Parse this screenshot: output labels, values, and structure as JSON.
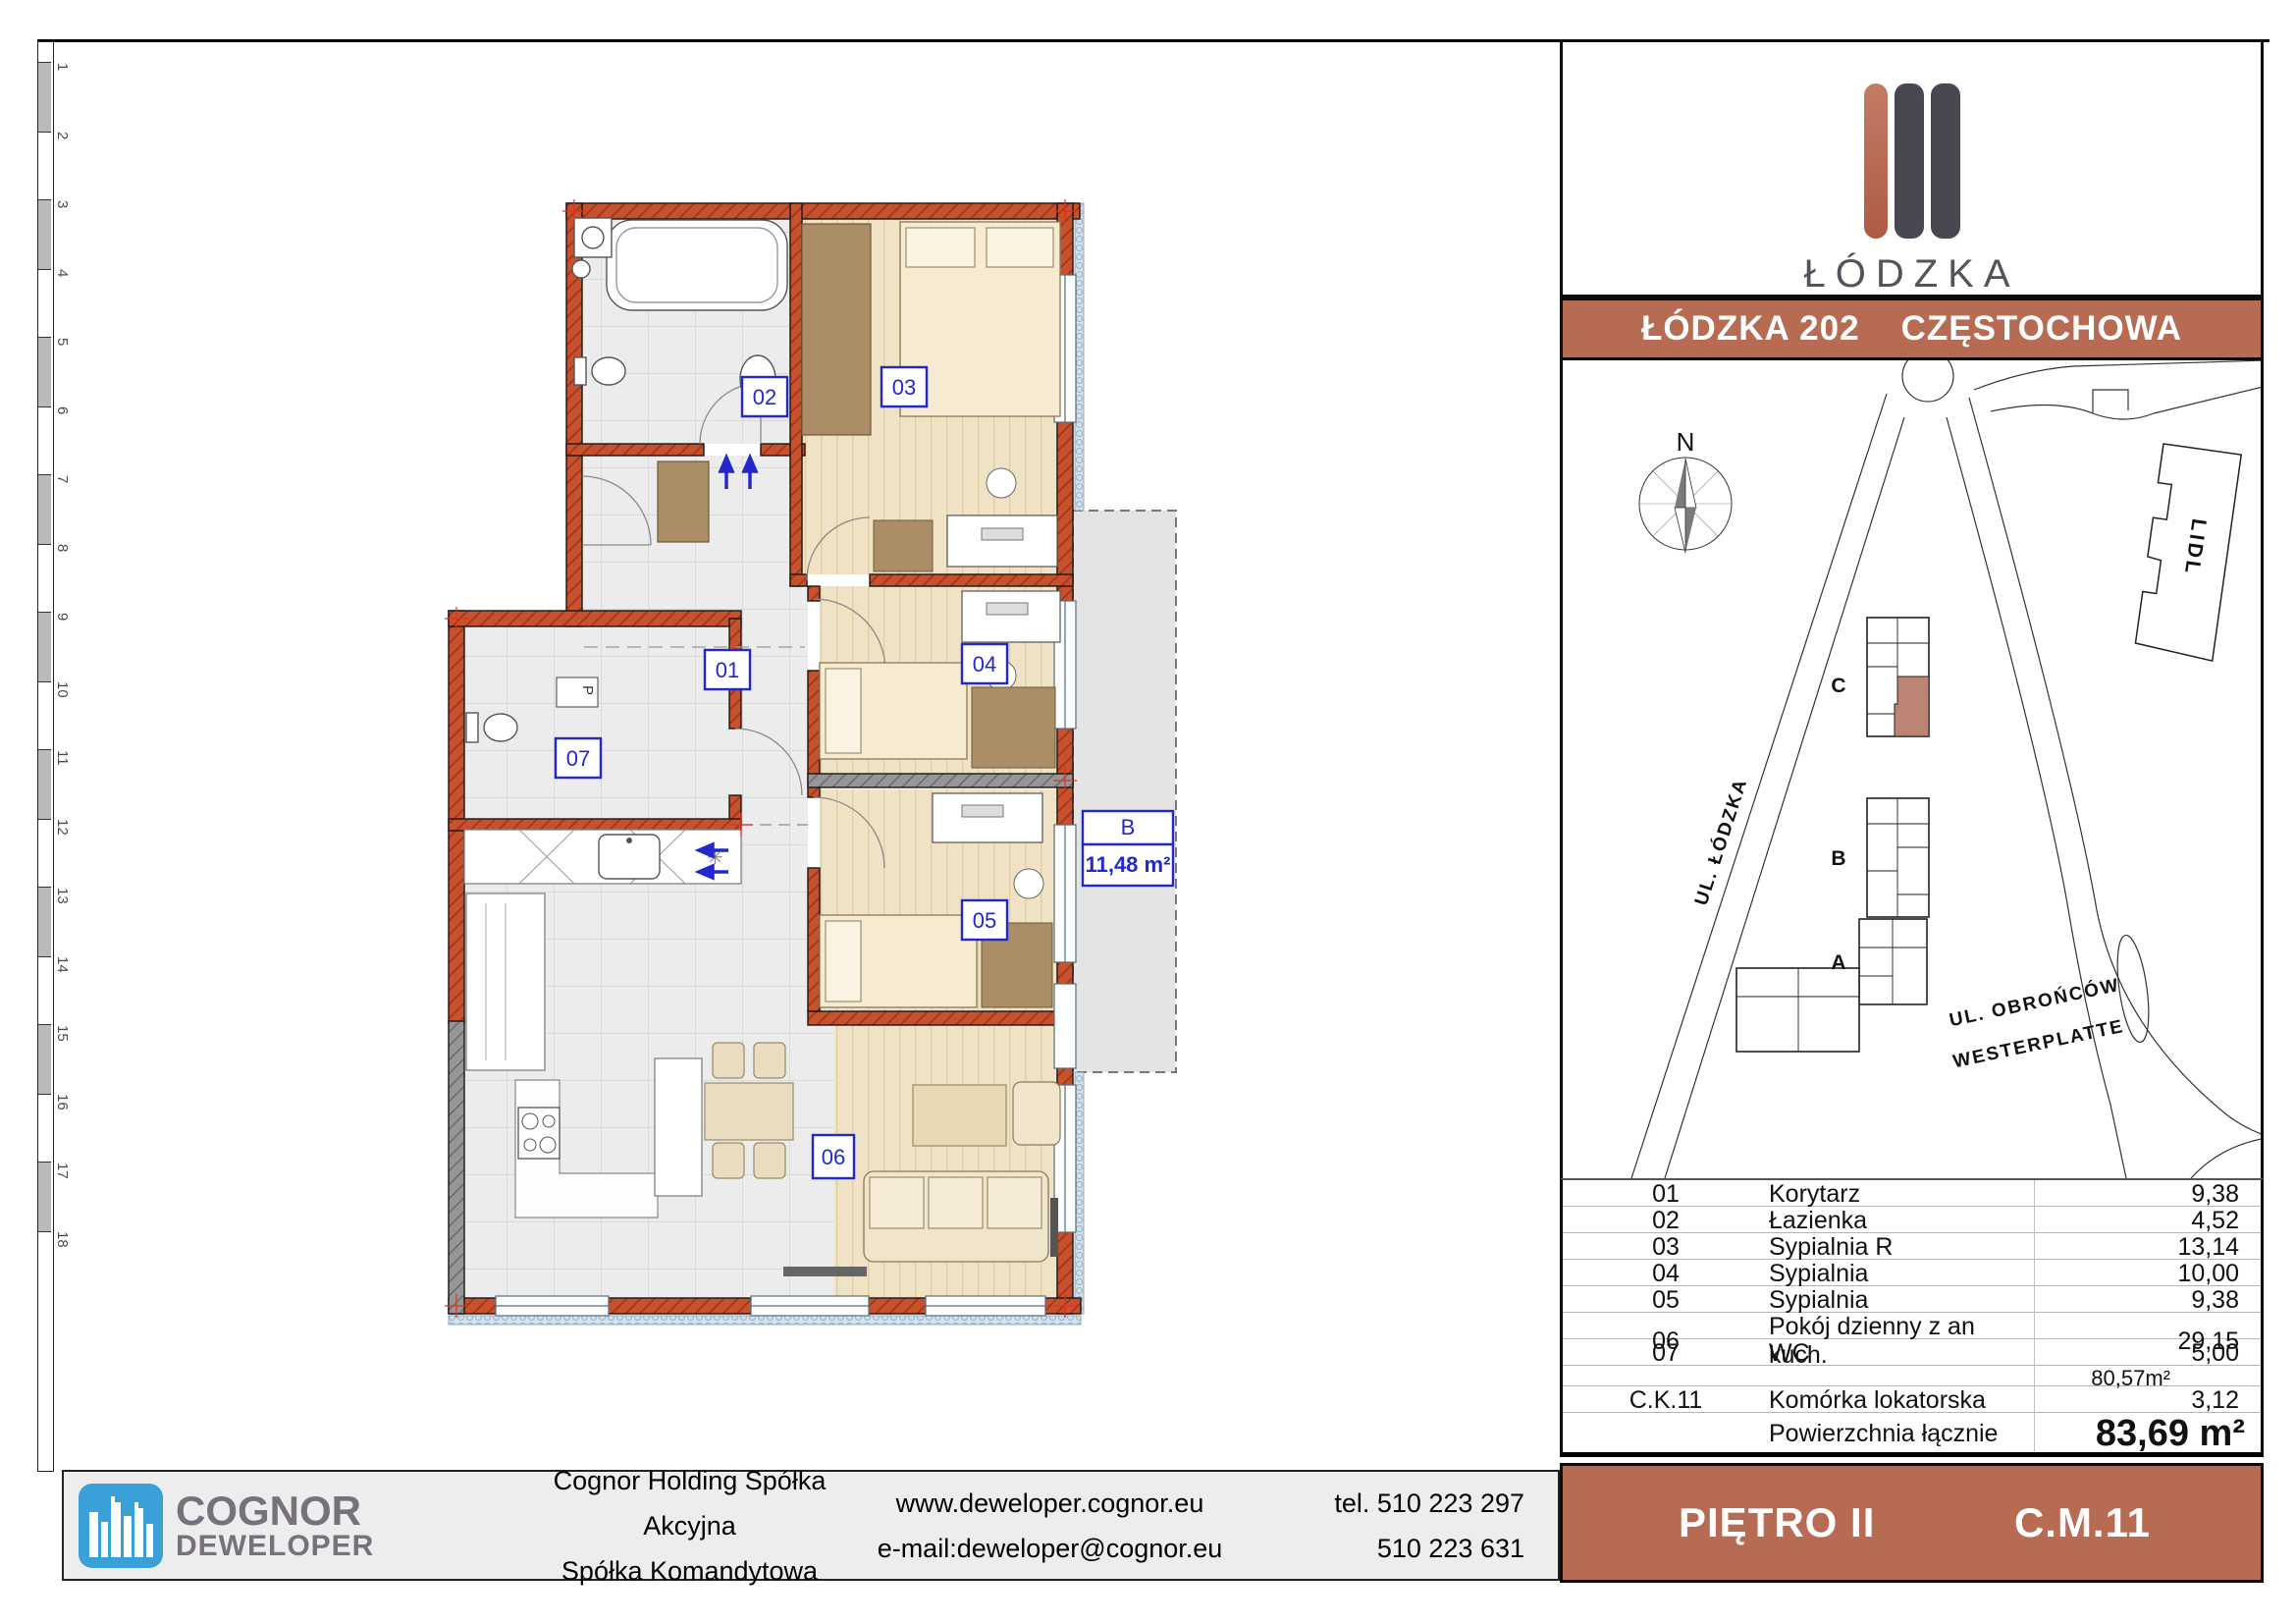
{
  "colors": {
    "accent_terracotta": "#b76b52",
    "wall_terracotta": "#c8502c",
    "wall_gray": "#969696",
    "label_blue": "#2228cc",
    "logo_blue": "#3aa0d8",
    "logo_dark_bar": "#484853",
    "map_unit_highlight": "#bc8472",
    "footer_bg": "#ededed",
    "balcony_gray": "#e4e4e4"
  },
  "ruler": {
    "numbers": [
      "1",
      "2",
      "3",
      "4",
      "5",
      "6",
      "7",
      "8",
      "9",
      "10",
      "11",
      "12",
      "13",
      "14",
      "15",
      "16",
      "17",
      "18"
    ]
  },
  "brand_panel": {
    "logo_title": "ŁÓDZKA",
    "logo_subtitle": "OSIEDLE"
  },
  "title_bar": {
    "project": "ŁÓDZKA 202",
    "city": "CZĘSTOCHOWA"
  },
  "map": {
    "north": "N",
    "lidl": "LIDL",
    "street_lodzka": "UL. ŁÓDZKA",
    "street_obroncow_line1": "UL. OBROŃCÓW",
    "street_obroncow_line2": "WESTERPLATTE",
    "building_a": "A",
    "building_b": "B",
    "building_c": "C"
  },
  "plan": {
    "labels": {
      "r01": "01",
      "r02": "02",
      "r03": "03",
      "r04": "04",
      "r05": "05",
      "r06": "06",
      "r07": "07",
      "shaft": "P"
    },
    "balcony": {
      "letter": "B",
      "area": "11,48 m²"
    }
  },
  "table": {
    "rows": [
      {
        "no": "01",
        "name": "Korytarz",
        "area": "9,38"
      },
      {
        "no": "02",
        "name": "Łazienka",
        "area": "4,52"
      },
      {
        "no": "03",
        "name": "Sypialnia R",
        "area": "13,14"
      },
      {
        "no": "04",
        "name": "Sypialnia",
        "area": "10,00"
      },
      {
        "no": "05",
        "name": "Sypialnia",
        "area": "9,38"
      },
      {
        "no": "06",
        "name": "Pokój dzienny z an kuch.",
        "area": "29,15"
      },
      {
        "no": "07",
        "name": "WC",
        "area": "5,00"
      },
      {
        "no": "",
        "name": "",
        "area": "80,57m²"
      },
      {
        "no": "C.K.11",
        "name": "Komórka lokatorska",
        "area": "3,12"
      },
      {
        "no": "",
        "name": "Powierzchnia łącznie",
        "area": "83,69 m²"
      }
    ]
  },
  "floor_bar": {
    "floor": "PIĘTRO II",
    "unit": "C.M.11"
  },
  "footer": {
    "brand_line1": "COGNOR",
    "brand_line2": "DEWELOPER",
    "company_line1": "Cognor Holding Spółka Akcyjna",
    "company_line2": "Spółka Komandytowa",
    "web": "www.deweloper.cognor.eu",
    "email": "e-mail:deweloper@cognor.eu",
    "tel1": "tel. 510 223 297",
    "tel2": "510 223 631"
  }
}
